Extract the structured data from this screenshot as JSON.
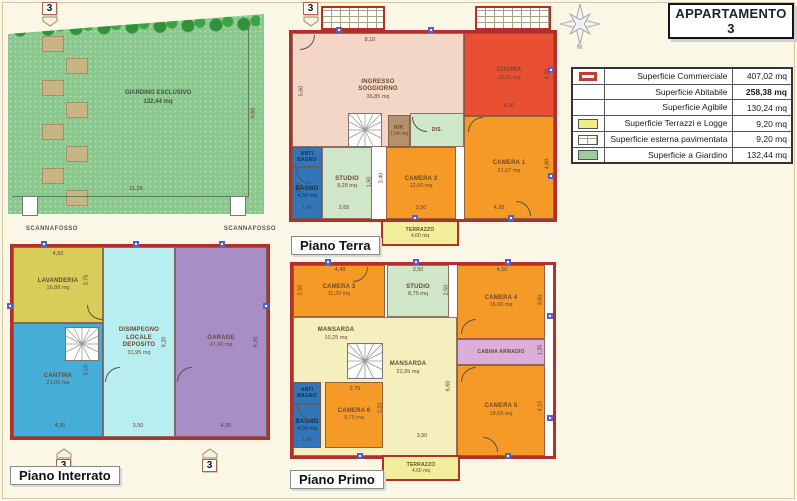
{
  "title": "APPARTAMENTO 3",
  "compass_label": "N",
  "palette": {
    "wall_red": "#b13129",
    "camera_orange": "#f59a26",
    "cucina_red": "#e84f33",
    "soggiorno_salmon": "#f3d6c6",
    "terrazzo_yellow": "#f2ee9b",
    "studio_green": "#cfe6c8",
    "bagno_blue": "#2f76ba",
    "disimpegno_cyan": "#b9eef1",
    "garage_purple": "#a78fc6",
    "lavanderia_olive": "#d8cd58",
    "cantina_teal": "#46aed6",
    "cabina_pink": "#dcaeda",
    "mansarda_cream": "#f4efbd",
    "garden_green": "#8bc88e"
  },
  "legend": {
    "rows": [
      {
        "swatch": "red-outline",
        "label": "Superficie Commerciale",
        "value": "407,02 mq"
      },
      {
        "swatch": "none",
        "label": "Superficie Abitabile",
        "value": "258,38 mq"
      },
      {
        "swatch": "none",
        "label": "Superficie Agibile",
        "value": "130,24 mq"
      },
      {
        "swatch": "yellow",
        "label": "Superficie Terrazzi e Logge",
        "value": "9,20 mq"
      },
      {
        "swatch": "brick",
        "label": "Superficie esterna pavimentata",
        "value": "9,20 mq"
      },
      {
        "swatch": "green",
        "label": "Superficie a Giardino",
        "value": "132,44 mq"
      }
    ]
  },
  "garden": {
    "marker": "3",
    "name": "GIARDINO ESCLUSIVO",
    "area": "132,44 mq",
    "dim_right": "9,65",
    "dim_bottom": "11,25",
    "scannafosso_left": "SCANNAFOSSO",
    "scannafosso_right": "SCANNAFOSSO"
  },
  "interrato": {
    "label": "Piano Interrato",
    "marker_left": "3",
    "marker_right": "3",
    "rooms": {
      "lavanderia": {
        "name": "LAVANDERIA",
        "area": "16,88 mq"
      },
      "cantina": {
        "name": "CANTINA",
        "area": "21,05 mq"
      },
      "disimpegno": {
        "name": "DISIMPEGNO LOCALE DEPOSITO",
        "area": "31,95 mq"
      },
      "garage": {
        "name": "GARAGE",
        "area": "41,40 mq"
      }
    },
    "dims": {
      "lavanderia_top": "4,50",
      "lavanderia_right": "3,75",
      "cantina_v": "5,10",
      "cantina_bottom": "4,35",
      "disimpegno_right": "9,20",
      "disimpegno_bottom": "3,50",
      "garage_right": "9,20",
      "garage_bottom": "4,35"
    }
  },
  "terra": {
    "label": "Piano Terra",
    "marker": "3",
    "rooms": {
      "soggiorno": {
        "name": "INGRESSO SOGGIORNO",
        "area": "36,85 mq"
      },
      "cucina": {
        "name": "CUCINA",
        "area": "18,06 mq"
      },
      "rip": {
        "name": "RIP.",
        "area": "1,54 mq"
      },
      "dis": {
        "name": "DIS."
      },
      "antibagno": {
        "name": "ANTI BAGNO"
      },
      "bagno": {
        "name": "BAGNO",
        "area": "4,00 mq"
      },
      "studio": {
        "name": "STUDIO",
        "area": "9,28 mq"
      },
      "camera2": {
        "name": "CAMERA 2",
        "area": "12,60 mq"
      },
      "camera1": {
        "name": "CAMERA 1",
        "area": "21,07 mq"
      },
      "terrazzo": {
        "name": "TERRAZZO",
        "area": "4,60 mq"
      }
    },
    "dims": {
      "top": "8,10",
      "soggiorno_left": "5,60",
      "cucina_right": "4,20",
      "cucina_bottom": "4,30",
      "camera1_right": "4,80",
      "camera1_bottom": "4,30",
      "camera2_left": "3,40",
      "camera2_bottom": "3,50",
      "studio_right": "1,50",
      "studio_bottom": "2,65",
      "bagno_left": "1,50",
      "bagno_bottom": "1,60"
    }
  },
  "primo": {
    "label": "Piano Primo",
    "rooms": {
      "camera3": {
        "name": "CAMERA 3",
        "area": "11,20 mq"
      },
      "studio": {
        "name": "STUDIO",
        "area": "8,75 mq"
      },
      "camera4": {
        "name": "CAMERA 4",
        "area": "16,00 mq"
      },
      "mansarda1": {
        "name": "MANSARDA",
        "area": "10,25 mq"
      },
      "mansarda2": {
        "name": "MANSARDA",
        "area": "22,95 mq"
      },
      "cabina": {
        "name": "CABINA ARMADIO"
      },
      "camera5": {
        "name": "CAMERA 5",
        "area": "18,69 mq"
      },
      "antibagno": {
        "name": "ANTI BAGNO"
      },
      "bagno": {
        "name": "BAGNO",
        "area": "4,00 mq"
      },
      "camera6": {
        "name": "CAMERA 6",
        "area": "9,75 mq"
      },
      "terrazzo": {
        "name": "TERRAZZO",
        "area": "4,60 mq"
      }
    },
    "dims": {
      "camera3_top": "4,48",
      "camera3_left": "2,50",
      "studio_top": "3,50",
      "studio_right": "2,50",
      "camera4_top": "4,50",
      "camera4_right": "3,60",
      "cabina_right": "1,35",
      "camera5_right": "4,15",
      "mansarda_right": "6,60",
      "mansarda_bottom": "3,50",
      "camera6_top": "2,79",
      "camera6_right": "3,23",
      "bagno_bottom": "1,60"
    }
  }
}
